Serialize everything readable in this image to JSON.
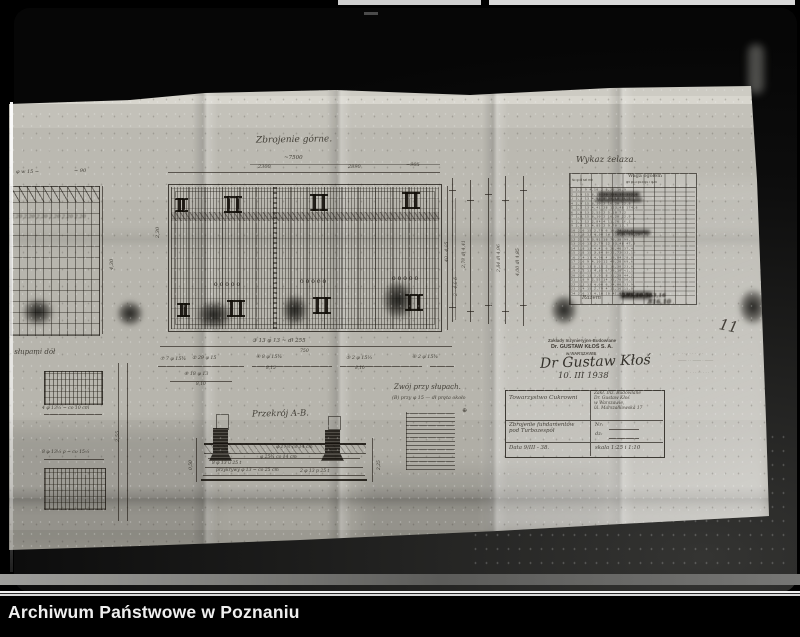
{
  "archive_caption": "Archiwum Państwowe w Poznaniu",
  "page_number": "11",
  "sheet": {
    "plan_title": "Zbrojenie górne.",
    "plan_dims": {
      "overall": "~7500",
      "left": "2300",
      "mid": "2890",
      "right": "~905"
    },
    "bar_lines": {
      "line1": "③ 13 φ 13 ~ dł 255",
      "line1_sub": "750",
      "m1": "⑦ 7 φ 15¾",
      "m2": "② 29 φ 15",
      "m3": "④ 8 φ 15¾",
      "m3_sub": "8,15",
      "m4": "⑤ 2 φ 15⅓",
      "m4_sub": "8,10",
      "m5": "⑥ 2 φ 15¾",
      "m6": "⑧ 18 φ 13",
      "m6_sub": "8,10"
    },
    "side_labels": {
      "l1": "2,30",
      "l2": "4,30",
      "r1": "40 · 4,05",
      "r2": "2 · 4,0 δ"
    },
    "vbar_labels": [
      "2,79 dł 4,41",
      "2,84 dł 4,96",
      "4,00 dł 4,85"
    ],
    "left_panel": {
      "note1": "φ w 15 ~",
      "note2": "~ 90",
      "row_labels": "2,20  2,20  2,20  2,20  2,20  2,20",
      "title": "… słupami dół",
      "dim_a": "4 φ 13⅓ ~ co 10 cm",
      "dim_b": "8 φ 13⅓ ρ ~ co 15⅓",
      "vdim": "2,55"
    },
    "iron_table": {
      "title": "Wykaz żelaza.",
      "group_header": "Waga ogółem",
      "col_header_left": "№ φ dł szt mb",
      "col_header_right": "φ9 φ13 φ15 φ17 φ25",
      "rows": [
        "1 2,2 9 4,10 2 8,20 16,9",
        "2 2,9 15 8,15 29 236,35 332,6",
        "3 3,0 13 4,96 8 39,68 56,1",
        "4 2,9 15 8,10 2 16,20 22,8",
        "5 2,2 13 4,41 28 123,48 174,6",
        "6 2,0 13 2,55 2 5,10 7,2",
        "7 1,8 15 8,10 2 16,20 22,9",
        "8 2,2 13 2,84 4 11,36 16,1",
        "9 2,4 13 4,85 2 9,70 13,7",
        "10 2,6 15 2,79 6 16,74 23,6",
        "11 2,9 13 4,00 34 136,00 192,3",
        "12 2,2 9 3,91 18 70,38 99,5",
        "13 2,0 13 2,79 12 33,48 47,3",
        "14 1,8 13 4,41 6 26,46 37,4",
        "15 2,2 15 2,84 8 22,72 32,1",
        "16 2,4 13 4,96 4 19,84 28,0",
        "17 2,6 9 4,10 12 49,20 69,6",
        "18 2,9 13 8,15 2 16,30 23,0",
        "19 2,2 15 4,85 6 29,10 41,1",
        "20 2,0 13 3,91 8 31,28 44,2",
        "21 1,8 9 2,55 14 35,70 50,5",
        "22 2,2 13 4,00 6 24,00 33,9",
        "23 2,4 15 2,79 4 11,16 15,8",
        "24 2,6 13 4,10 10 41,00 58,0"
      ],
      "footer_label": "Razem",
      "total1": "295,10  583,16",
      "total2": "816,10"
    },
    "stamp": {
      "line1": "Zakłady Inżynieryjno-Budowlane",
      "line2": "Dr. GUSTAW KŁOŚ S. A.",
      "line3": "w WARSZAWIE"
    },
    "signature": {
      "name": "Dr Gustaw Kłoś",
      "date": "10. III 1938"
    },
    "title_block": {
      "client": "Towarzystwo Cukrowni",
      "firm": "Zakł. Inż. Budowlane\nDr. Gustaw Kłoś\nw Warszawie,\nul. Marszałkowska 17",
      "subject": "Zbrojenie fundamentów\npod Turbozespół",
      "nr": "Nr:",
      "dz": "dz:",
      "date": "Data  9/III - 38.",
      "scale": "skala  1:25 i 1:10"
    },
    "faint_stamp": {
      "line1": "· · · · · · · · · · · ·",
      "line2": "—— · · —— · ——",
      "line3": "· · · · · · · ·"
    },
    "section": {
      "title": "Przekrój A-B.",
      "notes": [
        "φ 17½ co 14 cm",
        "φ 25¾ co 14 cm",
        "8 φ 13 u 25 t",
        "przykrywy φ 13 ~ co 25 cm",
        "2 φ 13 p 25 t"
      ],
      "dim_left": "0,50",
      "dim_right": "2,25"
    },
    "pit_detail": {
      "title": "Zwój przy słupach.",
      "subtitle": "(B) przy φ 15 — dł pręta około"
    }
  }
}
